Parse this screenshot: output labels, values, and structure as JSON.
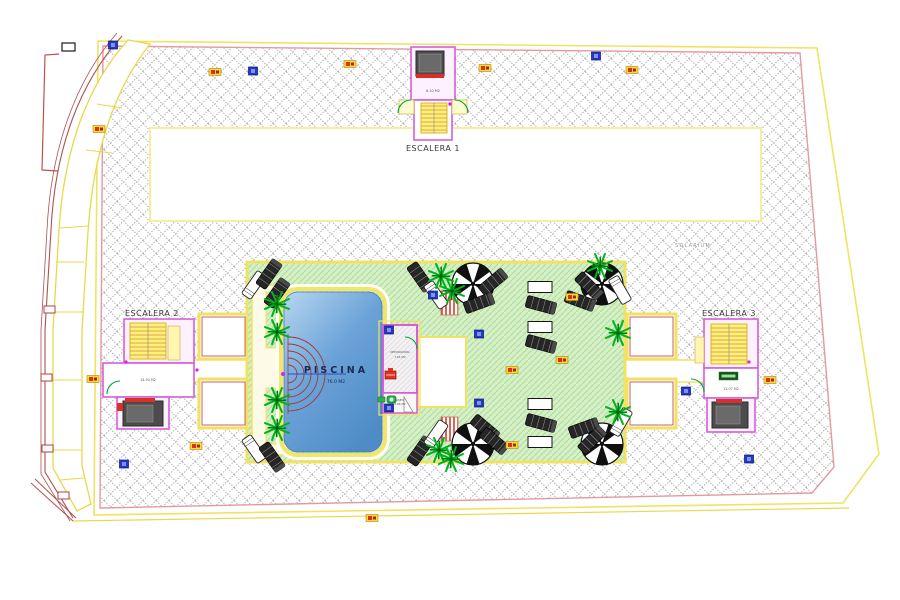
{
  "drawing": {
    "solarium_label": "SOLARIUM",
    "stairs": [
      {
        "label": "ESCALERA 1",
        "area": "6.10 M2"
      },
      {
        "label": "ESCALERA 2",
        "area": "14.50 M2"
      },
      {
        "label": "ESCALERA 3",
        "area": "11.07 M2"
      }
    ],
    "pool": {
      "label": "PISCINA",
      "area": "76.0 M2"
    },
    "plant_room": {
      "label": "DEPURADORA",
      "area": "7.61 M2"
    },
    "toilet": {
      "label": "ASEO",
      "area": "2.66 M2"
    },
    "colors": {
      "boundary_yellow": "#f2e262",
      "inner_pink": "#e09aa2",
      "wall_magenta": "#d65fd6",
      "lawn_green": "#d6efc6",
      "pool_blue": "#6ba3d8",
      "hatch_gray": "#9a9a9a",
      "door_green": "#00a83c",
      "accent_red": "#d83028",
      "marker_blue": "#2438c8",
      "marker_orange": "#ffd934"
    }
  }
}
